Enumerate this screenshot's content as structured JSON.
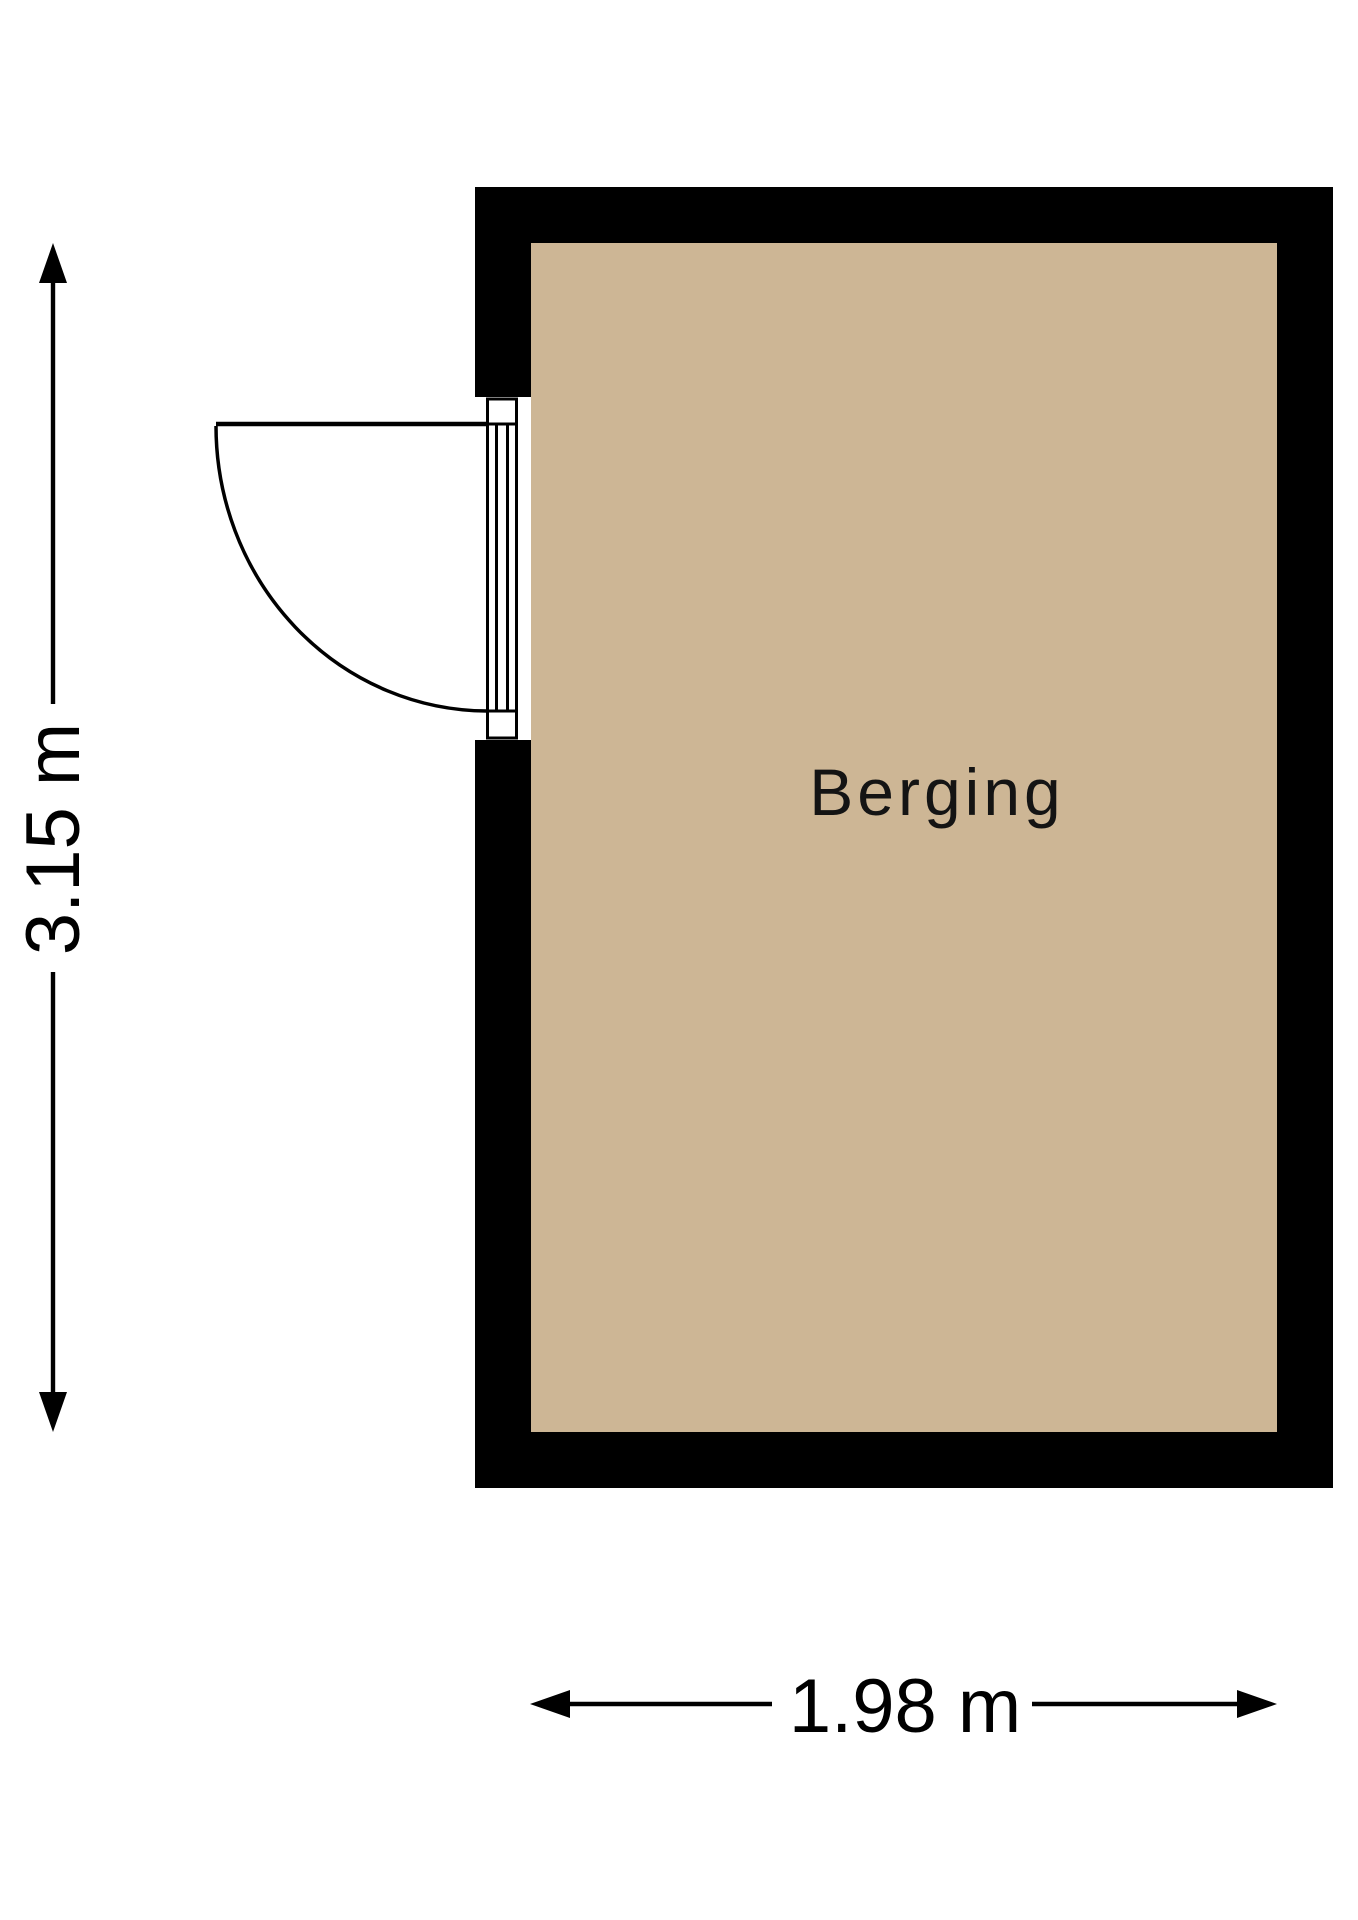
{
  "room": {
    "name": "Berging"
  },
  "dimensions": {
    "vertical_label": "3.15 m",
    "horizontal_label": "1.98 m"
  },
  "colors": {
    "floor": "#cdb695",
    "wall": "#000000",
    "dimension": "#000000",
    "background": "#ffffff"
  }
}
